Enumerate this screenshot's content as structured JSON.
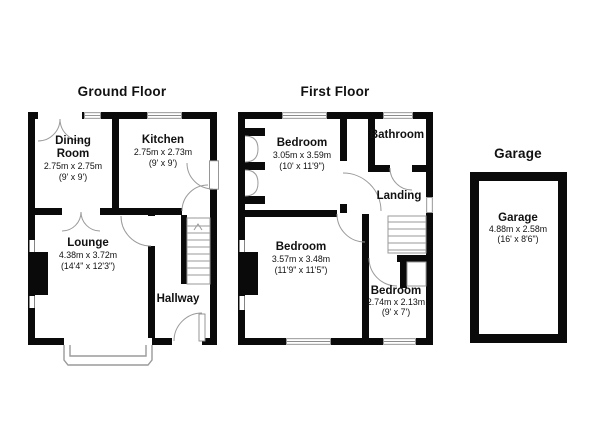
{
  "document_type": "property-floorplan",
  "colors": {
    "background": "#ffffff",
    "wall": "#0a0a0a",
    "symbol_line": "#9a9a9a",
    "window_frame": "#8c8c8c",
    "text": "#111111"
  },
  "floorplan": {
    "ground_floor": {
      "title": "Ground Floor",
      "rooms": {
        "dining_room": {
          "name_line1": "Dining",
          "name_line2": "Room",
          "dims_metric": "2.75m x 2.75m",
          "dims_imperial": "(9' x 9')"
        },
        "kitchen": {
          "name": "Kitchen",
          "dims_metric": "2.75m x 2.73m",
          "dims_imperial": "(9' x 9')"
        },
        "lounge": {
          "name": "Lounge",
          "dims_metric": "4.38m x 3.72m",
          "dims_imperial": "(14'4\" x 12'3\")"
        },
        "hallway": {
          "name": "Hallway"
        }
      }
    },
    "first_floor": {
      "title": "First Floor",
      "rooms": {
        "bedroom_rear": {
          "name": "Bedroom",
          "dims_metric": "3.05m x 3.59m",
          "dims_imperial": "(10' x 11'9\")"
        },
        "bathroom": {
          "name": "Bathroom"
        },
        "landing": {
          "name": "Landing"
        },
        "bedroom_front": {
          "name": "Bedroom",
          "dims_metric": "3.57m x 3.48m",
          "dims_imperial": "(11'9\" x 11'5\")"
        },
        "bedroom_small": {
          "name": "Bedroom",
          "dims_metric": "2.74m x 2.13m",
          "dims_imperial": "(9' x 7')"
        }
      }
    },
    "garage": {
      "title": "Garage",
      "room": {
        "name": "Garage",
        "dims_metric": "4.88m x 2.58m",
        "dims_imperial": "(16' x 8'6\")"
      }
    }
  }
}
